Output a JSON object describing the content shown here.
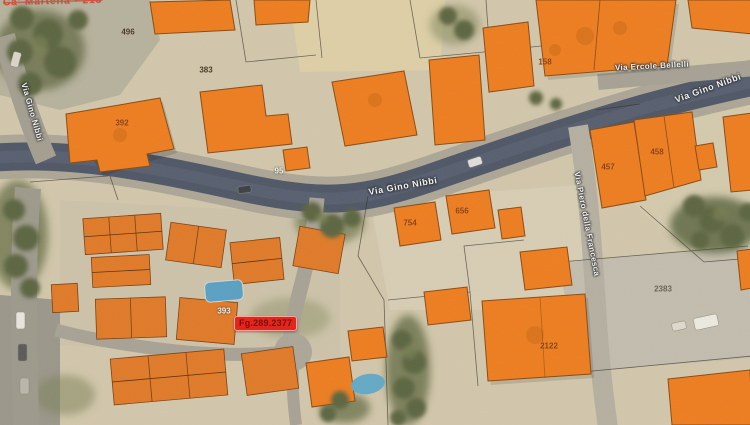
{
  "streets": {
    "gino_nibbi_main": "Via Gino Nibbi",
    "gino_nibbi_upper_right": "Via Gino Nibbi",
    "gino_nibbi_left": "Via Gino Nibbi",
    "ercole_bellelli": "Via Ercole Bellelli",
    "piero_della_francesca": "Via Piero della Francesca"
  },
  "parcels": {
    "n496": "496",
    "n383": "383",
    "n392": "392",
    "n95": "95",
    "n158": "158",
    "n457": "457",
    "n458": "458",
    "n754": "754",
    "n656": "656",
    "n2383": "2383",
    "n2122": "2122",
    "n393": "393"
  },
  "marker": {
    "label": "Fg.289.2377",
    "background": "#e3261d",
    "text_color": "#7c0f08"
  },
  "corner_annotation": "Ca' Martella - 213",
  "colors": {
    "terrain": "#d2c7ab",
    "road_asphalt": "#4f5766",
    "building_overlay": "#ED7D1F",
    "building_outline": "#8a4a12",
    "vegetation": "#5c6540"
  }
}
